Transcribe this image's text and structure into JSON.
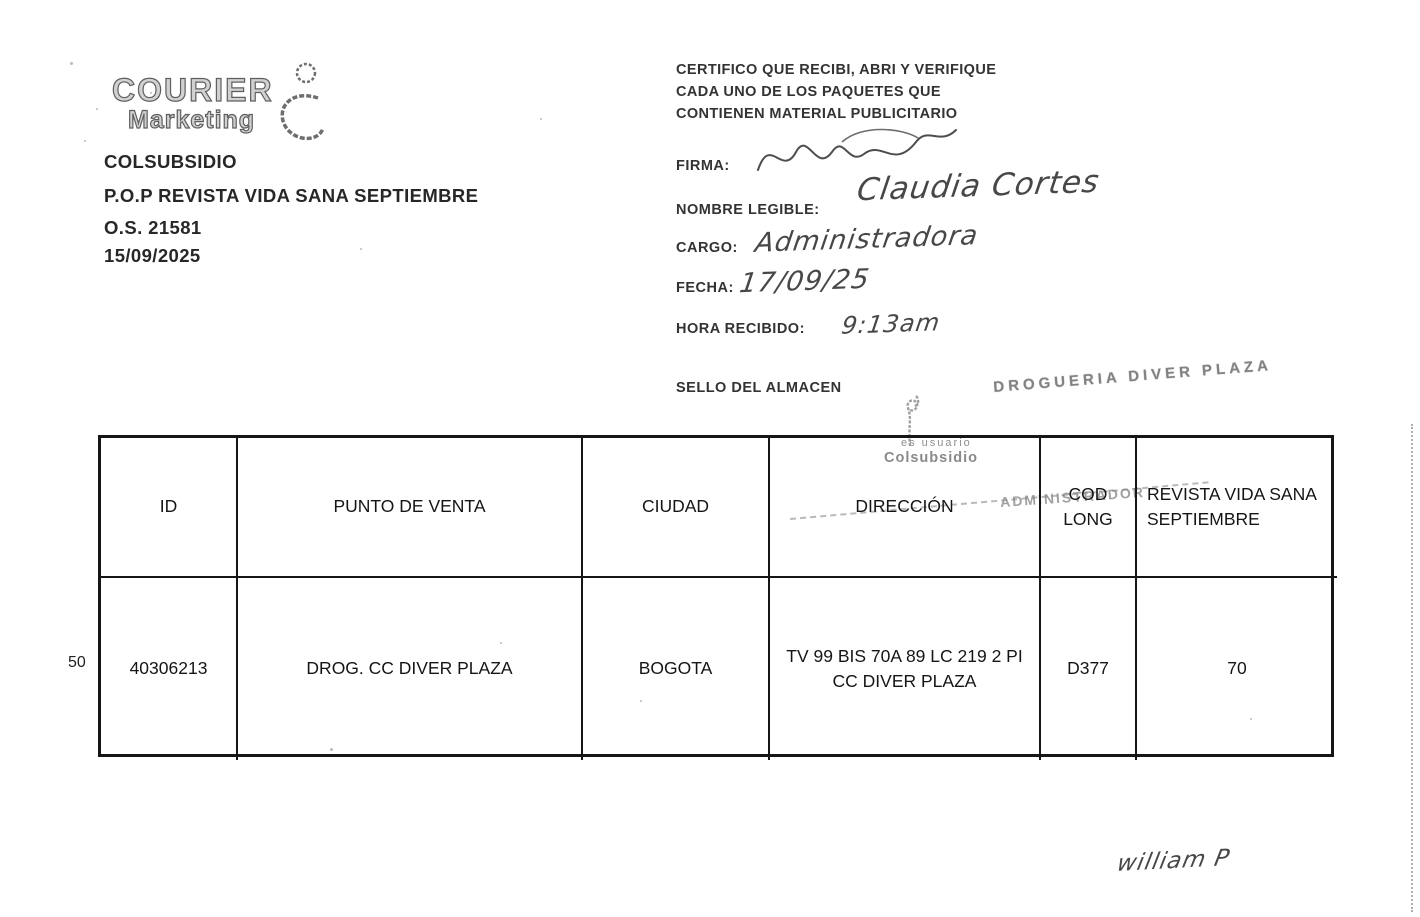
{
  "logo": {
    "name": "COURIER",
    "sub": "Marketing"
  },
  "order_block": {
    "client": "COLSUBSIDIO",
    "campaign": "P.O.P REVISTA VIDA SANA SEPTIEMBRE",
    "order_number": "O.S. 21581",
    "date": "15/09/2025"
  },
  "certification": {
    "line1": "CERTIFICO QUE RECIBI, ABRI Y VERIFIQUE",
    "line2": "CADA UNO DE LOS PAQUETES QUE",
    "line3": "CONTIENEN MATERIAL PUBLICITARIO"
  },
  "receipt_form": {
    "firma_label": "FIRMA:",
    "nombre_label": "NOMBRE LEGIBLE:",
    "cargo_label": "CARGO:",
    "fecha_label": "FECHA:",
    "hora_label": "HORA RECIBIDO:",
    "sello_label": "SELLO DEL ALMACEN",
    "nombre_value": "Claudia Cortes",
    "cargo_value": "Administradora",
    "fecha_value": "17/09/25",
    "hora_value": "9:13am"
  },
  "stamps": {
    "store": "DROGUERIA DIVER PLAZA",
    "usuario_top": "es usuario",
    "usuario_bottom": "Colsubsidio",
    "role": "ADMINISTRADOR"
  },
  "table": {
    "row_index": "50",
    "headers": [
      "ID",
      "PUNTO DE VENTA",
      "CIUDAD",
      "DIRECCIÓN",
      "COD LONG",
      "REVISTA VIDA SANA SEPTIEMBRE"
    ],
    "rows": [
      [
        "40306213",
        "DROG. CC DIVER PLAZA",
        "BOGOTA",
        "TV 99 BIS 70A 89 LC 219 2 PI CC DIVER PLAZA",
        "D377",
        "70"
      ]
    ]
  },
  "footer": {
    "courier_signature": "william P"
  }
}
